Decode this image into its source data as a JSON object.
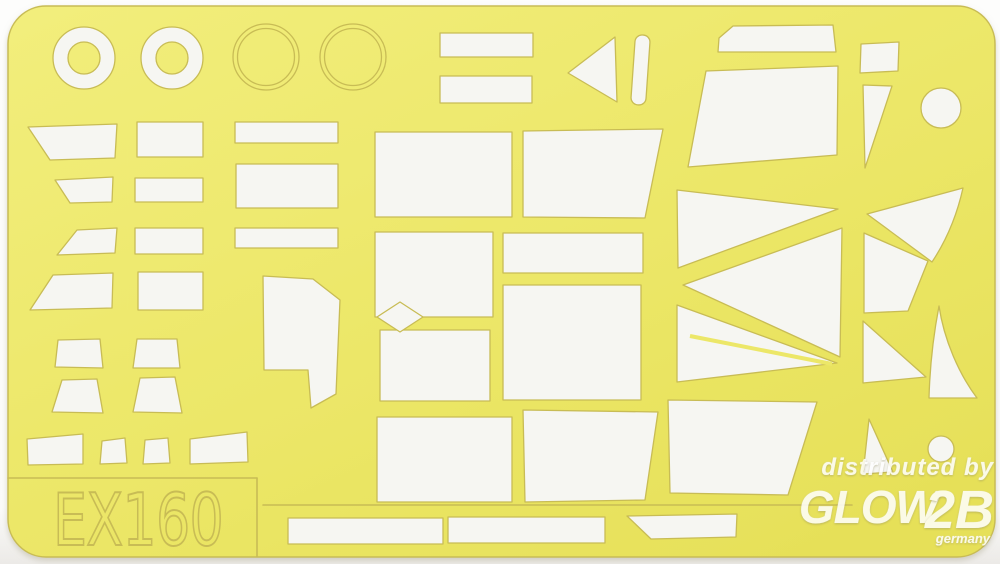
{
  "product_label": {
    "code": "EX160"
  },
  "watermark": {
    "distributed_by": "distributed by",
    "brand_glow": "GLOW",
    "brand_2b": "2B",
    "country": "germany"
  },
  "colors": {
    "sheet_yellow": "#ece768",
    "sheet_yellow_light": "#f2ee7c",
    "sheet_yellow_deep": "#e6e058",
    "outline": "#c8bc55",
    "mask_white": "#f6f6f2",
    "watermark_white": "#ffffff",
    "background": "#fdfdfc"
  }
}
